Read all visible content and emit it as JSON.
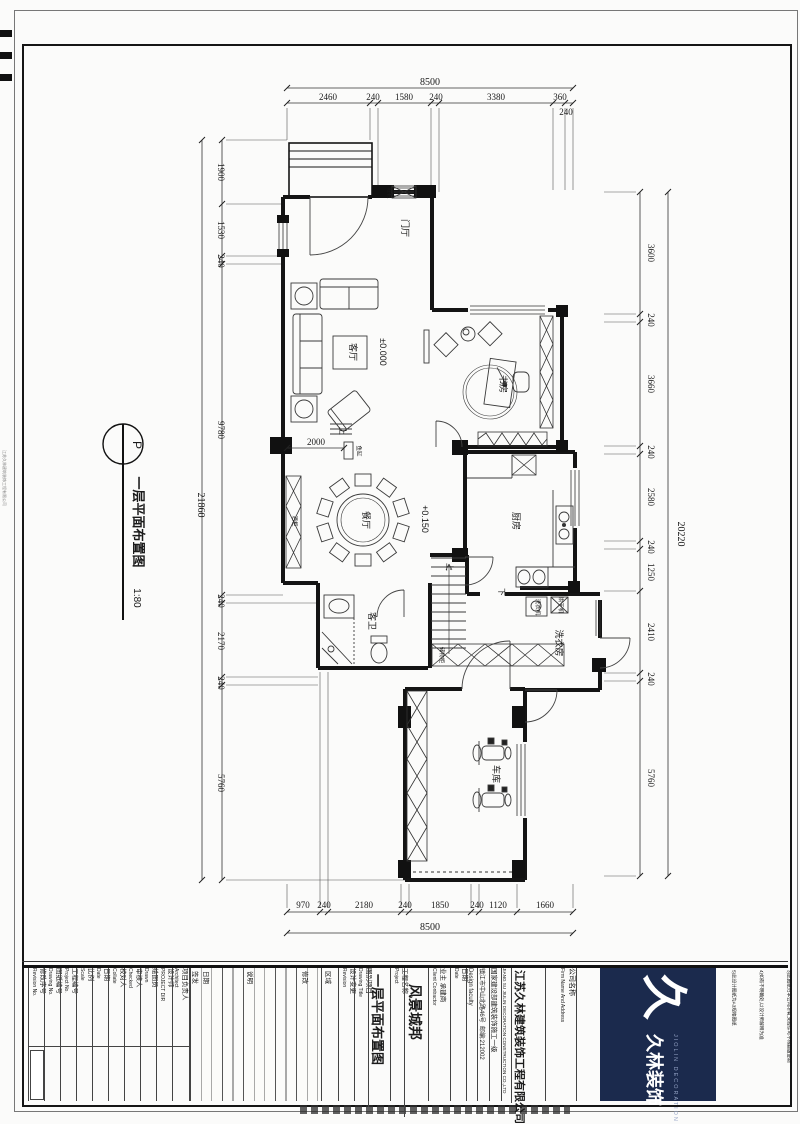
{
  "marker": {
    "code": "P",
    "title": "一层平面布置图",
    "scale": "1:80"
  },
  "margin_text": "江苏久林建筑装饰工程有限公司",
  "dims": {
    "top": {
      "total": "8500",
      "segments": [
        "2460",
        "240",
        "1580",
        "240",
        "3380",
        "360"
      ],
      "below": "240"
    },
    "bottom": {
      "total": "8500",
      "segments": [
        "970",
        "240",
        "2180",
        "240",
        "1850",
        "240",
        "1120",
        "1660"
      ]
    },
    "left": {
      "total": "21860",
      "segments": [
        "1900",
        "1530",
        "240",
        "9780",
        "240",
        "2170",
        "240",
        "5760"
      ]
    },
    "right": {
      "total": "20220",
      "segments": [
        "3600",
        "240",
        "3660",
        "240",
        "2580",
        "240",
        "1250",
        "2410",
        "240",
        "5760"
      ]
    },
    "interior": {
      "fish_tank_width": "2000"
    }
  },
  "rooms": {
    "entry": "门厅",
    "living": "客厅",
    "study": "书房",
    "dining": "餐厅",
    "kitchen": "厨房",
    "guest_bath": "客卫",
    "laundry": "洗衣房",
    "garage": "车库"
  },
  "levels": {
    "living": "±0.000",
    "dining": "+0.150"
  },
  "stairs": {
    "up": "上",
    "down": "下"
  },
  "furniture": {
    "shoe_cabinet": "鞋柜",
    "wine_cabinet": "酒柜",
    "storage_cabinet": "储物柜",
    "washer": "洗衣机",
    "dryer": "烘干机",
    "fish_tank": "鱼缸"
  },
  "title_block": {
    "fields": [
      {
        "en": "Revision No.",
        "zh": "修改序号"
      },
      {
        "en": "Drawing No.",
        "zh": "图纸编号"
      },
      {
        "en": "Project No.",
        "zh": "工程编号"
      },
      {
        "en": "Scale",
        "zh": "比例"
      },
      {
        "en": "Date",
        "zh": "日期"
      },
      {
        "en": "Collate",
        "zh": "校对人"
      },
      {
        "en": "Checked",
        "zh": "审核人"
      },
      {
        "en": "Drawn",
        "zh": "绘图员"
      },
      {
        "en": "PROJECT DIR",
        "zh": "设计师"
      },
      {
        "en": "Architect",
        "zh": "项目负责人"
      }
    ],
    "revision_table": {
      "headers": [
        "签发",
        "日期",
        "说明",
        "修改"
      ],
      "zone": "区域",
      "label_zh": "设计变更",
      "label_en": "Revision"
    },
    "drawing_title": {
      "zh": "图别项目",
      "en": "Drawing Title",
      "value": "一层平面布置图"
    },
    "project": {
      "zh": "工程名称",
      "en": "Project",
      "value": "风景城邦"
    },
    "client": {
      "zh": "业主 承建商",
      "en": "Client Contractor"
    },
    "date2": {
      "zh": "日期",
      "en": "Date"
    },
    "faculty": "Design faculty",
    "address": "镇江市中山北路46号  邮编:212002",
    "qualification": "国家建设部建筑装饰施工一级",
    "company_en": "JIANG SU JIULIN DECORATION CONSTRUCTION CO.,LTD",
    "company_zh": "江苏久林建筑装饰工程有限公司",
    "firm": {
      "zh": "公司名称",
      "en": "Firm Name And Address"
    },
    "logo": {
      "glyph": "久",
      "zh": "久林装饰",
      "en": "JIOLIN DECORATION"
    },
    "notes": {
      "header": "备注 Notes",
      "items": [
        "1)图纸尺寸、标高尺寸均以实际测量为准",
        "2)所有尺寸必须经现场复核后方可施工",
        "3)此图纸归本公司所有,未经许可不得翻版复制",
        "4)如有不明确处,以设计师解释为准",
        "5)此设计图纸为A3规格图纸"
      ]
    }
  }
}
